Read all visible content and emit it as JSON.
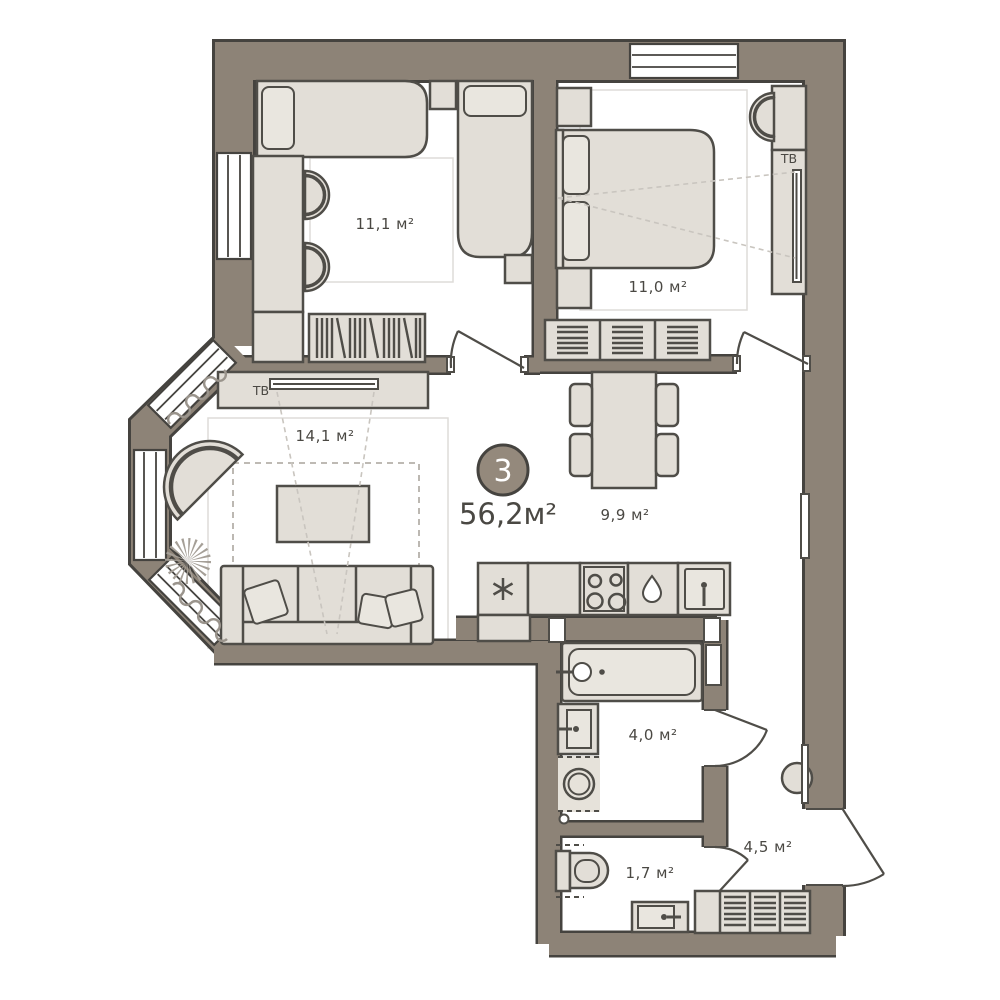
{
  "badge": {
    "number": "3",
    "total_area_label": "56,2м²"
  },
  "rooms": {
    "bedroom1": {
      "area_label": "11,1 м²"
    },
    "bedroom2": {
      "area_label": "11,0 м²"
    },
    "living": {
      "area_label": "14,1 м²"
    },
    "dining": {
      "area_label": "9,9 м²"
    },
    "bath": {
      "area_label": "4,0 м²"
    },
    "wc": {
      "area_label": "1,7 м²"
    },
    "hall": {
      "area_label": "4,5 м²"
    }
  },
  "tv": {
    "bedroom_label": "ТВ",
    "living_label": "ТВ"
  },
  "colors": {
    "wall": "#8d8377",
    "outline": "#45433f",
    "furniture_fill": "#e2ded7",
    "floor": "#ffffff",
    "badge_fill": "#94897c",
    "text": "#4a4843",
    "dashed_line": "#c9c5bf"
  }
}
